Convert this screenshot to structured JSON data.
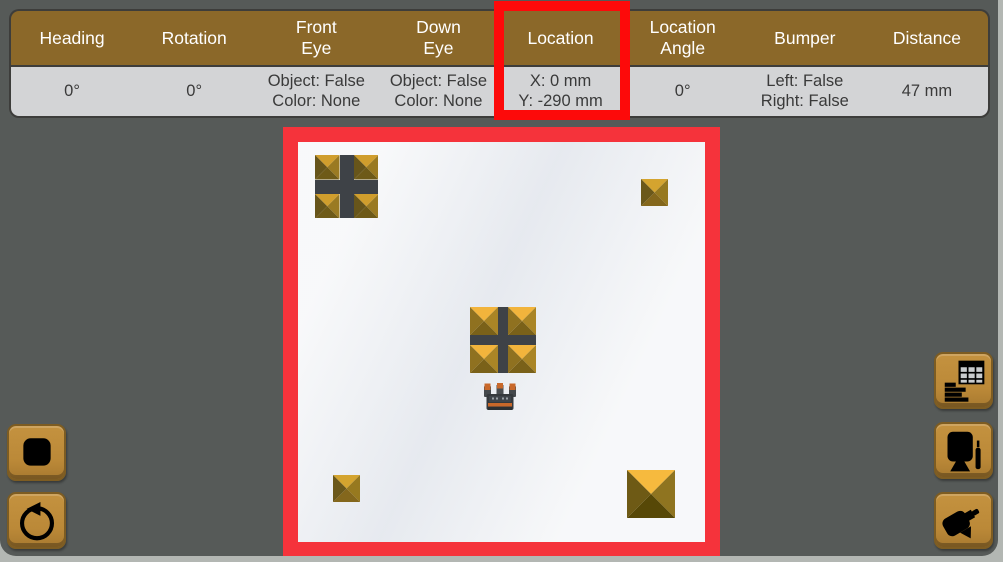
{
  "sensor_table": {
    "columns": [
      {
        "id": "heading",
        "label_lines": [
          "Heading"
        ],
        "value_lines": [
          "0°"
        ]
      },
      {
        "id": "rotation",
        "label_lines": [
          "Rotation"
        ],
        "value_lines": [
          "0°"
        ]
      },
      {
        "id": "front-eye",
        "label_lines": [
          "Front",
          "Eye"
        ],
        "value_lines": [
          "Object: False",
          "Color: None"
        ]
      },
      {
        "id": "down-eye",
        "label_lines": [
          "Down",
          "Eye"
        ],
        "value_lines": [
          "Object: False",
          "Color: None"
        ]
      },
      {
        "id": "location",
        "label_lines": [
          "Location"
        ],
        "value_lines": [
          "X: 0 mm",
          "Y: -290 mm"
        ],
        "highlighted": true
      },
      {
        "id": "location-angle",
        "label_lines": [
          "Location",
          "Angle"
        ],
        "value_lines": [
          "0°"
        ]
      },
      {
        "id": "bumper",
        "label_lines": [
          "Bumper"
        ],
        "value_lines": [
          "Left: False",
          "Right: False"
        ]
      },
      {
        "id": "distance",
        "label_lines": [
          "Distance"
        ],
        "value_lines": [
          "47 mm"
        ]
      }
    ]
  },
  "colors": {
    "panel_bg": "#565A58",
    "window_edge": "#B3B7B3",
    "header_brown": "#8B6829",
    "value_gray": "#D3D4D6",
    "button_gold": "#BB8938",
    "highlight_red": "#FD0A0A",
    "field_border_red": "#F5333B",
    "field_bg": "#EFF1F4",
    "cross_dark": "#3E4247",
    "robot_orange": "#C9682A"
  },
  "pyramid_colors": {
    "gold": {
      "top": "#F2B43C",
      "left": "#8F7120",
      "right": "#AA8526",
      "bottom": "#7A6119"
    },
    "gold_small": {
      "top": "#D4A42F",
      "left": "#6B581A",
      "right": "#97791F",
      "bottom": "#84671C"
    },
    "gold_large": {
      "top": "#F6BA3E",
      "left": "#6E5A15",
      "right": "#8F7420",
      "bottom": "#574807"
    },
    "olive": {
      "top": "#D09E2D",
      "left": "#67551A",
      "right": "#9A7A22",
      "bottom": "#6E5A18"
    }
  },
  "field": {
    "objects": [
      {
        "type": "cross-block",
        "name": "cross-block-top-left",
        "x": 32,
        "y": 28,
        "size": 63,
        "arm": 14,
        "colors": "olive"
      },
      {
        "type": "pyramid",
        "name": "pyramid-top-right",
        "x": 358,
        "y": 52,
        "size": 27,
        "colors": "gold_small"
      },
      {
        "type": "cross-block",
        "name": "cross-block-center",
        "x": 187,
        "y": 180,
        "size": 66,
        "arm": 10,
        "colors": "gold"
      },
      {
        "type": "robot",
        "name": "robot",
        "x": 201,
        "y": 256,
        "w": 32,
        "h": 28
      },
      {
        "type": "pyramid",
        "name": "pyramid-bottom-left",
        "x": 50,
        "y": 348,
        "size": 27,
        "colors": "gold_small"
      },
      {
        "type": "pyramid",
        "name": "pyramid-bottom-right",
        "x": 344,
        "y": 343,
        "size": 48,
        "colors": "gold_large"
      }
    ]
  },
  "buttons": {
    "left": [
      {
        "id": "stop",
        "icon": "stop-square-icon"
      },
      {
        "id": "reset",
        "icon": "reset-arrow-icon"
      }
    ],
    "right": [
      {
        "id": "sensor-data",
        "icon": "data-table-icon"
      },
      {
        "id": "monitor",
        "icon": "monitor-pen-icon"
      },
      {
        "id": "camera",
        "icon": "camera-icon"
      }
    ]
  }
}
